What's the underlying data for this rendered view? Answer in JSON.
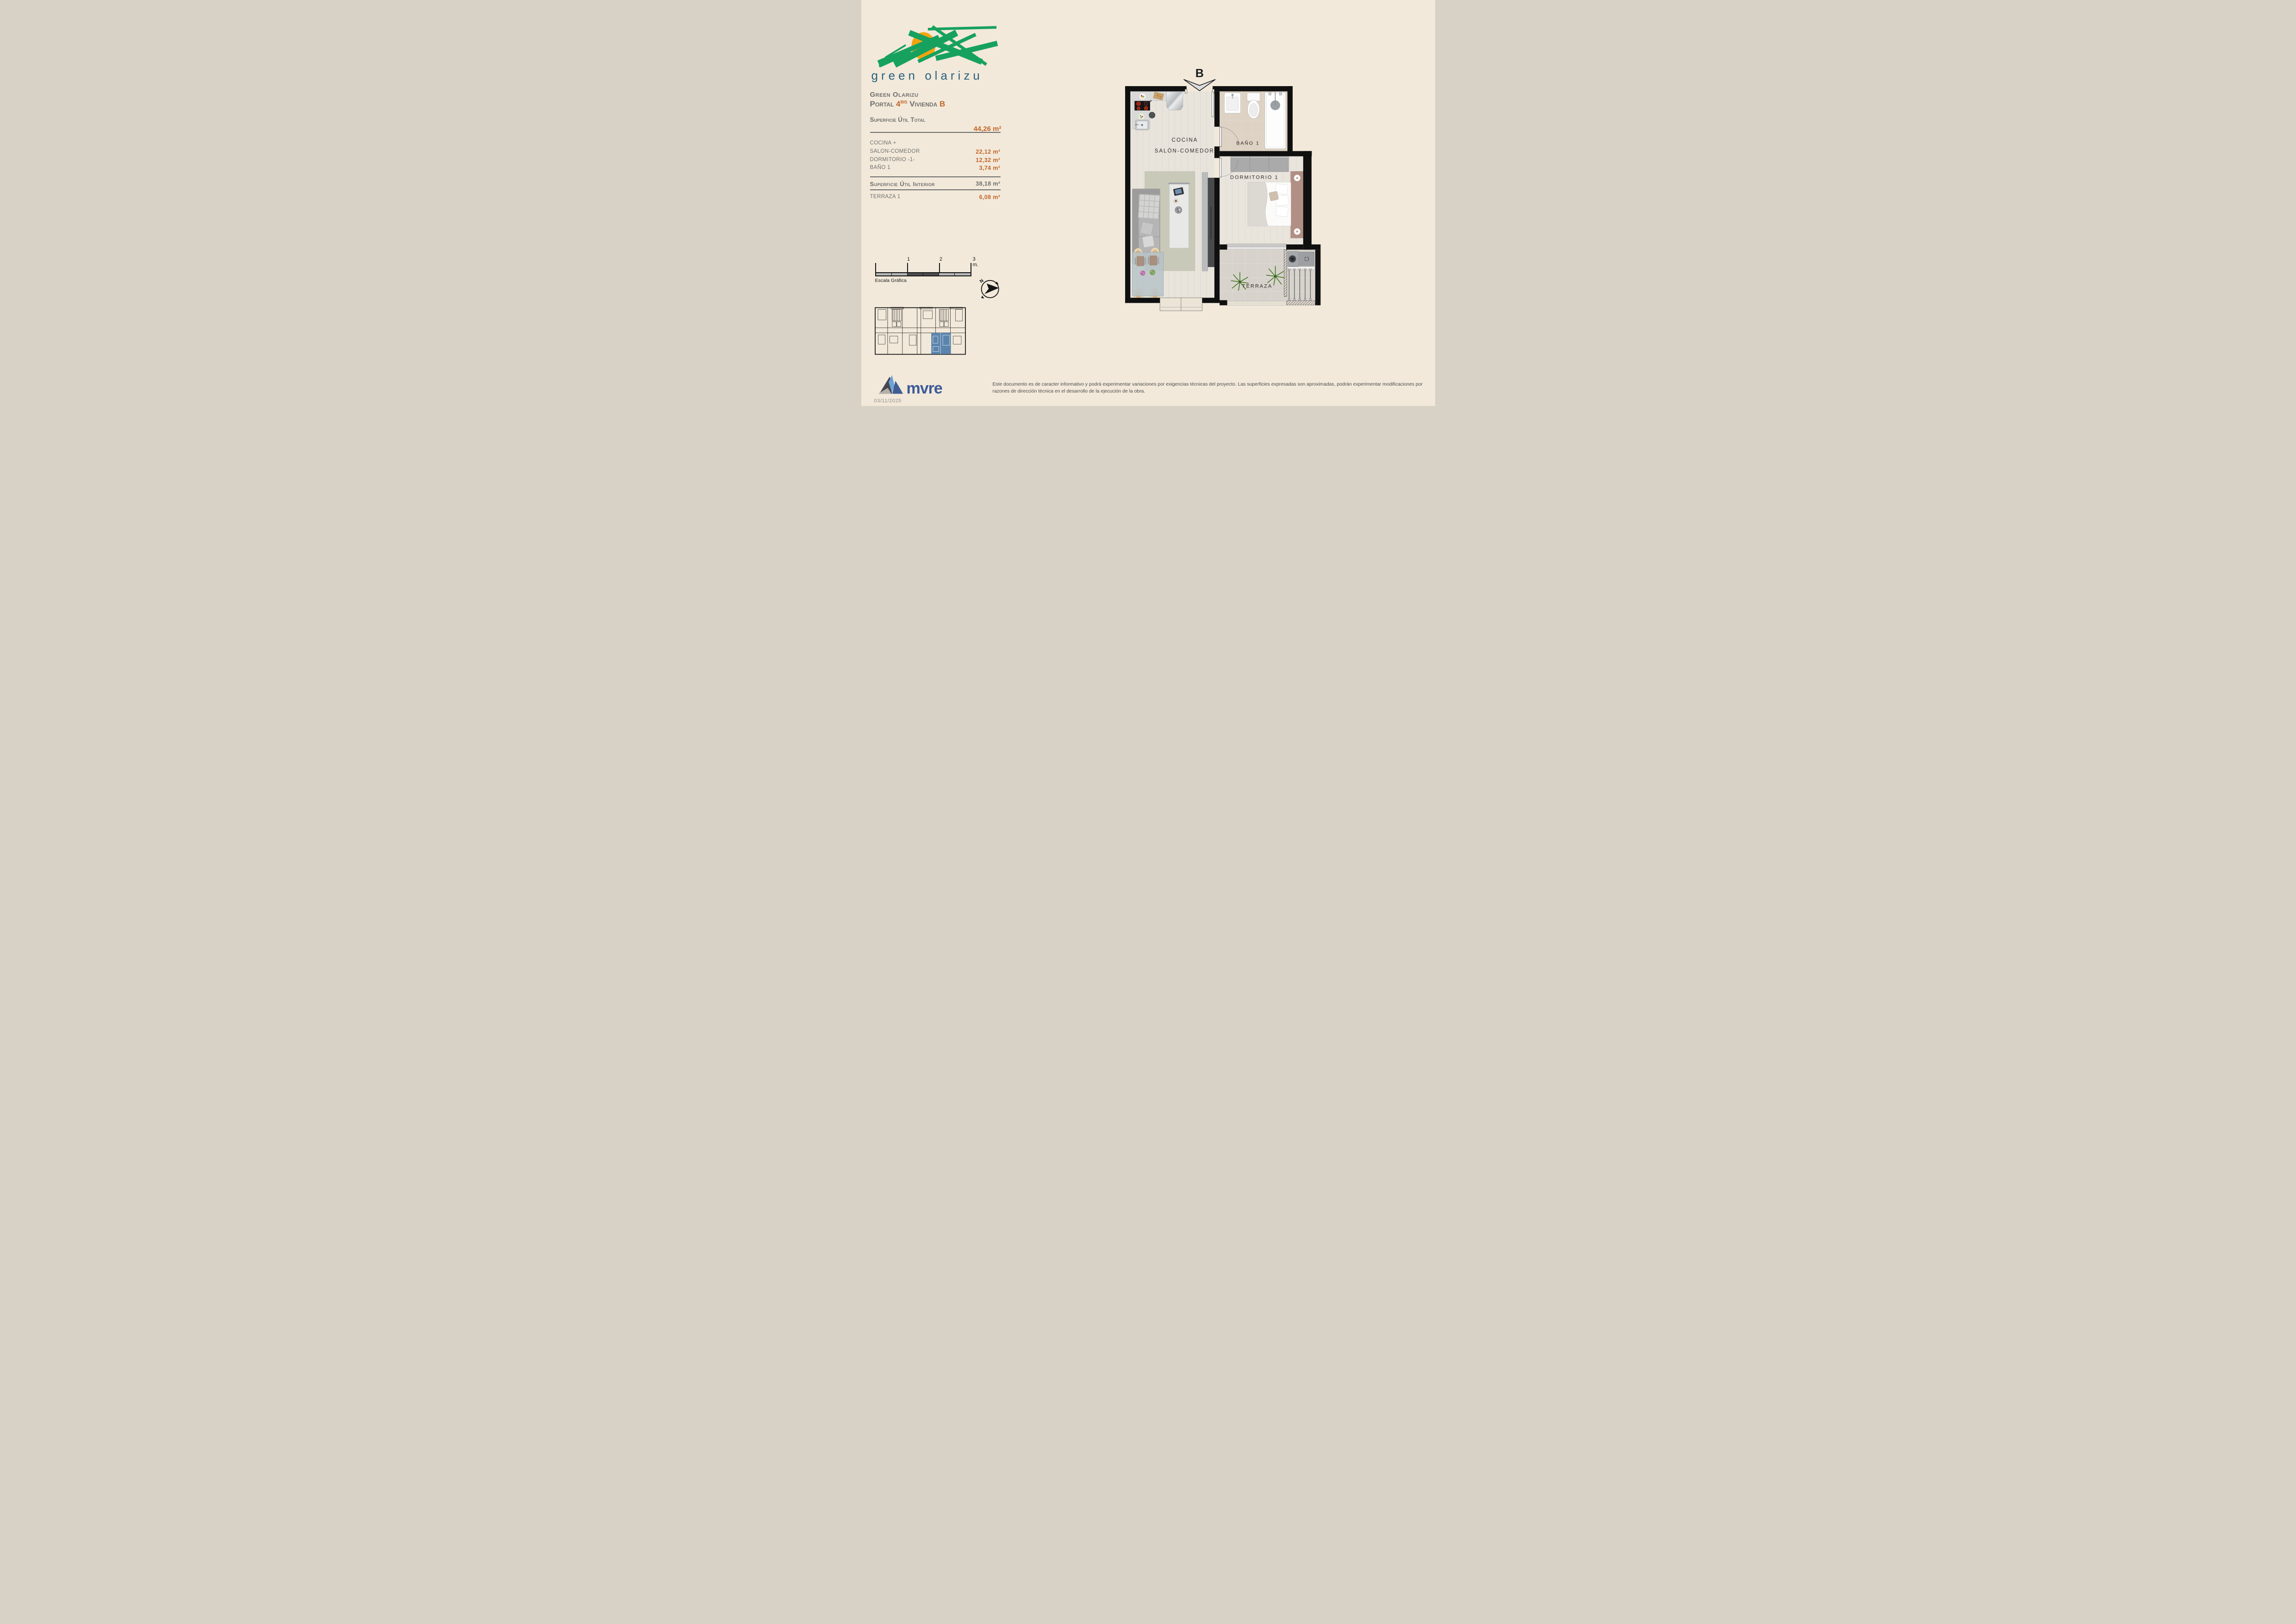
{
  "brand": {
    "logo_text": "green olarizu",
    "logo_green": "#17a15f",
    "logo_sun": "#f2a40e",
    "logo_text_color": "#27617e"
  },
  "header": {
    "project": "Green Olarizu",
    "portal_label": "Portal",
    "portal_value": "4",
    "portal_sup": "BIS",
    "vivienda_label": "Vivienda",
    "vivienda_value": "B"
  },
  "areas": {
    "total_label": "Superficie Útil Total",
    "total_value": "44,26 m²",
    "rows": [
      {
        "label": "COCINA +",
        "value": ""
      },
      {
        "label": "SALON-COMEDOR",
        "value": "22,12 m²"
      },
      {
        "label": "DORMITORIO -1-",
        "value": "12,32 m²"
      },
      {
        "label": "BAÑO 1",
        "value": "3,74 m²"
      }
    ],
    "interior_label": "Superficie Útil Interior",
    "interior_value": "38,18 m²",
    "terrace_label": "TERRAZA 1",
    "terrace_value": "6,08 m²"
  },
  "scale_bar": {
    "label": "Escala Gráfica",
    "tick_1": "1",
    "tick_2": "2",
    "tick_3": "3 m."
  },
  "compass": {
    "north_label": "N"
  },
  "plan": {
    "entrance_label": "B",
    "rooms": {
      "cocina": "COCINA",
      "salon": "SALÓN-COMEDOR",
      "bano": "BAÑO 1",
      "dormitorio": "DORMITORIO 1",
      "terraza": "TERRAZA"
    }
  },
  "key_plan": {
    "highlight_color": "#5b84ad"
  },
  "footer": {
    "brand_word": "mvre",
    "date": "03/11/2025",
    "disclaimer_line1": "Este documento es de caracter informativo y podrá experimentar variaciones por exigencias técnicas del proyecto. Las superficies expresadas son aproximadas, podrán experimentar modificaciones por",
    "disclaimer_line2": "razones de dirección técnica en el desarrollo de la ejecución de la obra."
  },
  "colors": {
    "background": "#f2e9da",
    "accent_orange": "#c2662b",
    "text_gray": "#6f6f6e",
    "wall_black": "#101010"
  }
}
